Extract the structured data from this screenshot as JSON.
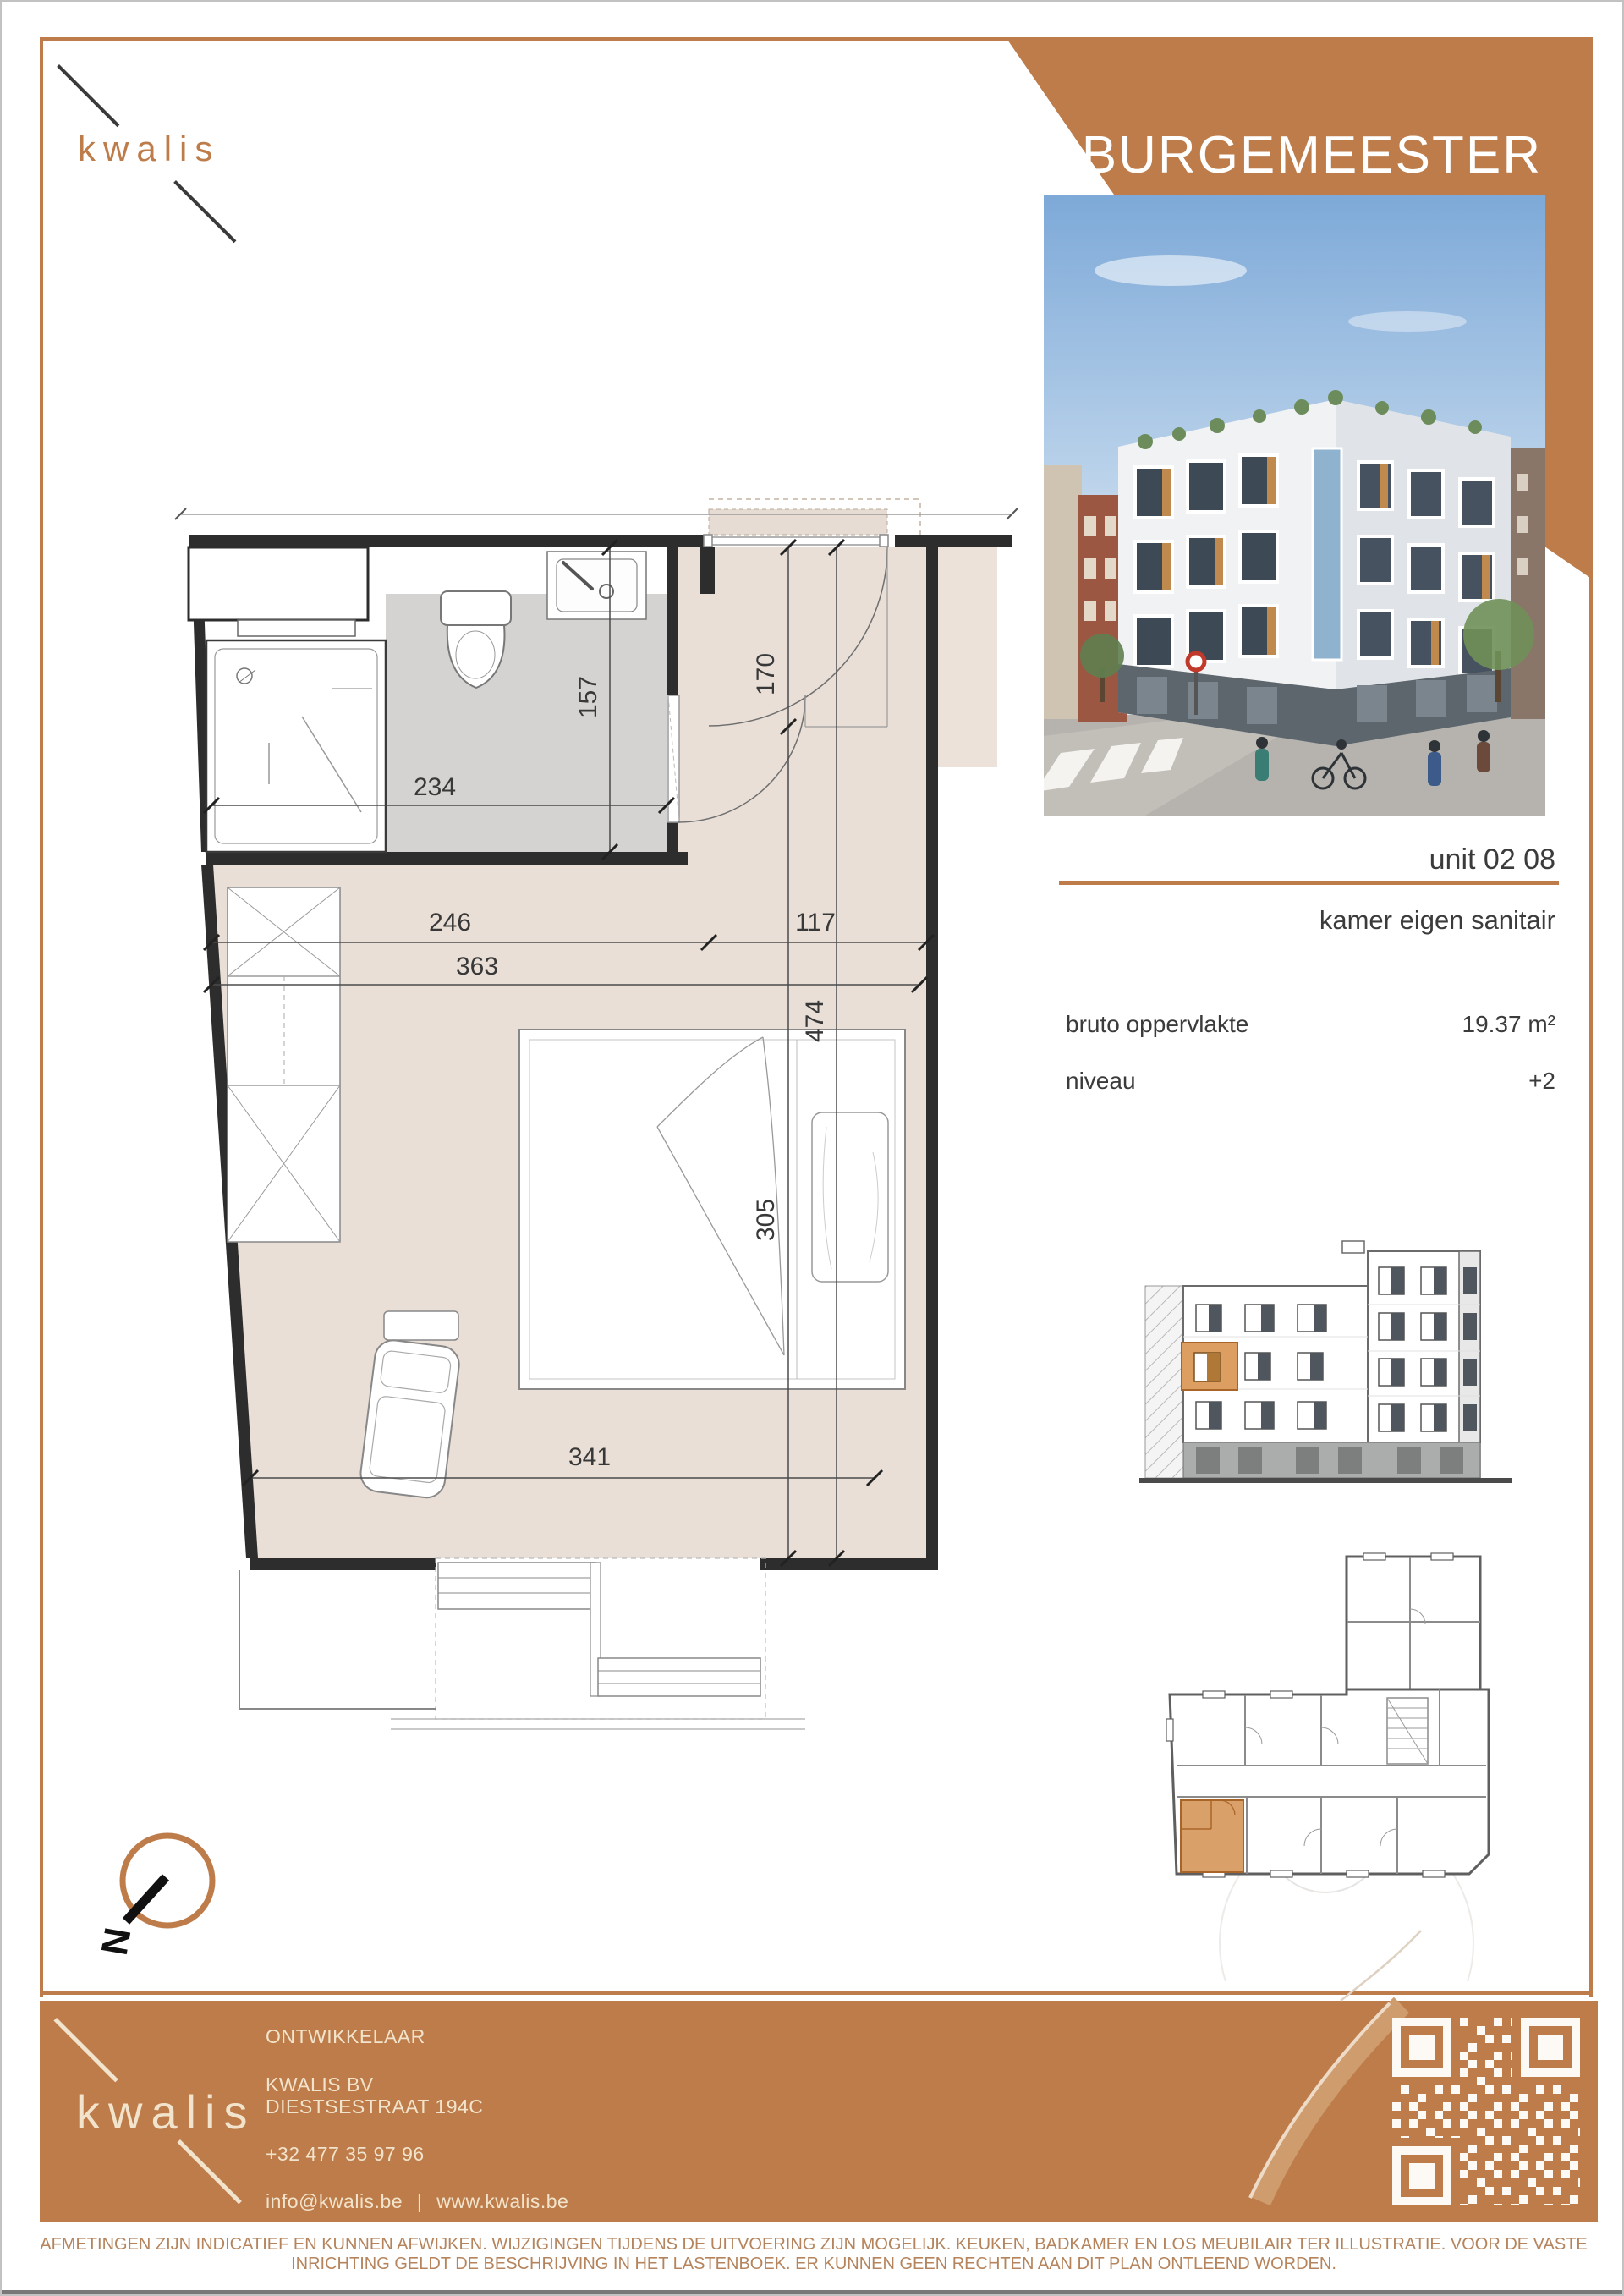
{
  "branding": {
    "logo_text": "kwalis",
    "accent_color": "#bd7c49",
    "logo_text_color_header": "#bd7c49",
    "logo_text_color_footer": "#f2e4cc"
  },
  "header": {
    "project_name": "BURGEMEESTER",
    "address_line1": "Blijde Inkomststraat 63",
    "address_line2": "3000 Leuven"
  },
  "unit": {
    "unit_label": "unit 02 08",
    "type_label": "kamer eigen sanitair",
    "area_label": "bruto oppervlakte",
    "area_value": "19.37 m²",
    "level_label": "niveau",
    "level_value": "+2"
  },
  "floorplan": {
    "dimensions": {
      "bath_width": "234",
      "bath_depth": "157",
      "entry_depth": "170",
      "left_width": "246",
      "entry_width": "117",
      "mid_width": "363",
      "room_depth": "474",
      "bed_length": "305",
      "bottom_width": "341"
    }
  },
  "compass": {
    "north_label": "N"
  },
  "footer": {
    "developer_heading": "ONTWIKKELAAR",
    "company": "KWALIS BV",
    "street": "DIESTSESTRAAT 194C",
    "phone": "+32 477 35 97 96",
    "email": "info@kwalis.be",
    "separator": "|",
    "website": "www.kwalis.be"
  },
  "disclaimer": {
    "line1": "AFMETINGEN ZIJN INDICATIEF EN KUNNEN AFWIJKEN. WIJZIGINGEN TIJDENS DE UITVOERING ZIJN MOGELIJK. KEUKEN, BADKAMER EN LOS MEUBILAIR TER ILLUSTRATIE. VOOR DE VASTE",
    "line2": "INRICHTING GELDT DE BESCHRIJVING IN HET LASTENBOEK. ER KUNNEN GEEN RECHTEN AAN DIT PLAN ONTLEEND WORDEN."
  }
}
